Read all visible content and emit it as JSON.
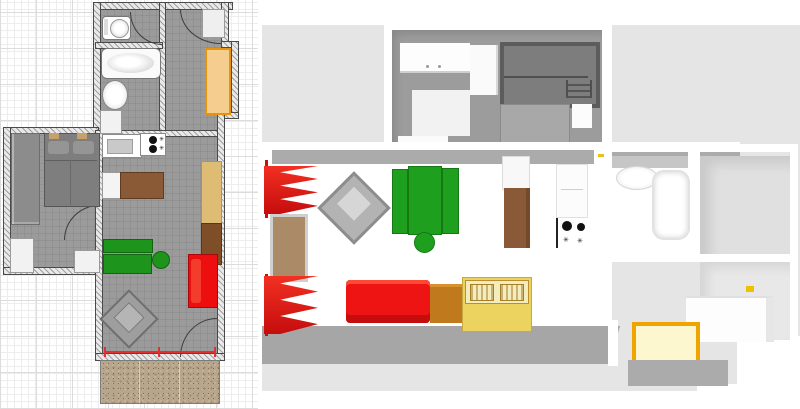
{
  "app": {
    "name": "floor-plan-editor",
    "layout": "2d-plan-left-3d-aerial-preview-right",
    "visible_text": "none"
  },
  "colors": {
    "plan_floor_gray": "#9b9b9b",
    "wall_fill": "#e9e9e9",
    "wall_line": "#4a4a4a",
    "grid_minor": "#ededed",
    "grid_major": "#dcdcdc",
    "accent_red": "#ed0f0f",
    "curtain_red": "#e01010",
    "accent_green": "#1d951d",
    "hall_wardrobe_fill": "#f5cd8e",
    "hall_wardrobe_border": "#e8930c",
    "wood_brown": "#8a5a36",
    "dark_brown": "#7d4e27",
    "chest_orange_brown": "#c1791e",
    "cabinet_tan": "#dfbc73",
    "table_yellow": "#ecd35f",
    "table_top_pale": "#f3ecbc",
    "window_frame_yellow": "#efa400",
    "window_glass_pale_yellow": "#fcf7cf",
    "terrace_gravel": "#b7a68b",
    "ground_3d": "#e5e5e5",
    "bedroom_floor_3d": "#9c9c9c",
    "bed_gray": "#7e7e7e",
    "bunk_bed_gray": "#6b6b6b"
  },
  "plan2d": {
    "grid": {
      "minor_px": 7,
      "major_px": 36
    },
    "rooms": [
      {
        "name": "wc"
      },
      {
        "name": "bathroom"
      },
      {
        "name": "hallway"
      },
      {
        "name": "bedroom"
      },
      {
        "name": "living-room-kitchen"
      },
      {
        "name": "terrace",
        "texture": "gravel"
      }
    ],
    "furniture": [
      {
        "name": "toilet",
        "color": "#ffffff"
      },
      {
        "name": "bathtub",
        "color": "#ffffff"
      },
      {
        "name": "washbasin",
        "color": "#ffffff"
      },
      {
        "name": "bath-cabinet",
        "color": "#f2f2f2"
      },
      {
        "name": "hall-cabinet",
        "color": "#efefef"
      },
      {
        "name": "hall-wardrobe",
        "color": "#f5cd8e"
      },
      {
        "name": "double-bed",
        "color": "#7e7e7e",
        "pillows": 2
      },
      {
        "name": "bedroom-wardrobe",
        "color": "#8c8c8c"
      },
      {
        "name": "bedroom-desk",
        "color": "#f2f2f2"
      },
      {
        "name": "bedroom-side-table",
        "color": "#f2f2f2"
      },
      {
        "name": "kitchen-sink",
        "color": "#c9c9c9"
      },
      {
        "name": "cooktop",
        "burners": 2,
        "color": "#ffffff"
      },
      {
        "name": "kitchen-table",
        "color": "#8a5a36"
      },
      {
        "name": "tall-cabinet",
        "color": "#dfbc73"
      },
      {
        "name": "chest",
        "color": "#7d4e27"
      },
      {
        "name": "dining-table",
        "color": "#1d951d"
      },
      {
        "name": "bench",
        "color": "#1d951d"
      },
      {
        "name": "stool",
        "color": "#1d951d"
      },
      {
        "name": "sofa",
        "color": "#ed0f0f"
      },
      {
        "name": "armchair",
        "color": "#9e9e9e",
        "rotation_deg": 45
      },
      {
        "name": "terrace-window",
        "color": "#e23030"
      }
    ],
    "doors": [
      "wc-door",
      "hall-door",
      "bedroom-door",
      "terrace-door"
    ]
  },
  "view3d": {
    "camera": "aerial-top-down",
    "ground_color": "#e5e5e5",
    "rooms": [
      "children-bedroom",
      "living-room",
      "kitchen",
      "bathroom",
      "right-room-upper",
      "right-room-lower"
    ],
    "furniture": [
      {
        "name": "bunk-bed",
        "color": "#6b6b6b"
      },
      {
        "name": "double-bed",
        "color": "#a8a8a8"
      },
      {
        "name": "white-wardrobe",
        "color": "#fdfdfd",
        "handles": 2
      },
      {
        "name": "white-column-cabinet",
        "color": "#fafafa"
      },
      {
        "name": "red-curtain-upper",
        "color": "#e01010"
      },
      {
        "name": "red-curtain-lower",
        "color": "#e01010"
      },
      {
        "name": "balcony-door",
        "color": "#ab8a68"
      },
      {
        "name": "armchair",
        "color": "#b3b3b3",
        "rotation_deg": 45
      },
      {
        "name": "dining-table-green",
        "color": "#1ea01e"
      },
      {
        "name": "bench-green",
        "count": 2,
        "color": "#1ea01e"
      },
      {
        "name": "stool-green",
        "color": "#1ea01e"
      },
      {
        "name": "sofa-red",
        "color": "#ee1414"
      },
      {
        "name": "chest-brown",
        "color": "#c1791e"
      },
      {
        "name": "games-table-yellow",
        "color": "#ecd35f"
      },
      {
        "name": "kitchen-upper-cabinet",
        "color": "#f8f8f8"
      },
      {
        "name": "kitchen-table-brown",
        "color": "#8a5a38"
      },
      {
        "name": "fridge",
        "color": "#fcfcfc"
      },
      {
        "name": "cooktop",
        "burners": 2,
        "color": "#ffffff"
      },
      {
        "name": "washbasin",
        "color": "#ffffff"
      },
      {
        "name": "bathtub",
        "color": "#ffffff"
      },
      {
        "name": "sideboard-white",
        "color": "#fdfdfd"
      },
      {
        "name": "yellow-frame-window",
        "frame": "#efa400",
        "glass": "#fcf7cf"
      }
    ]
  }
}
